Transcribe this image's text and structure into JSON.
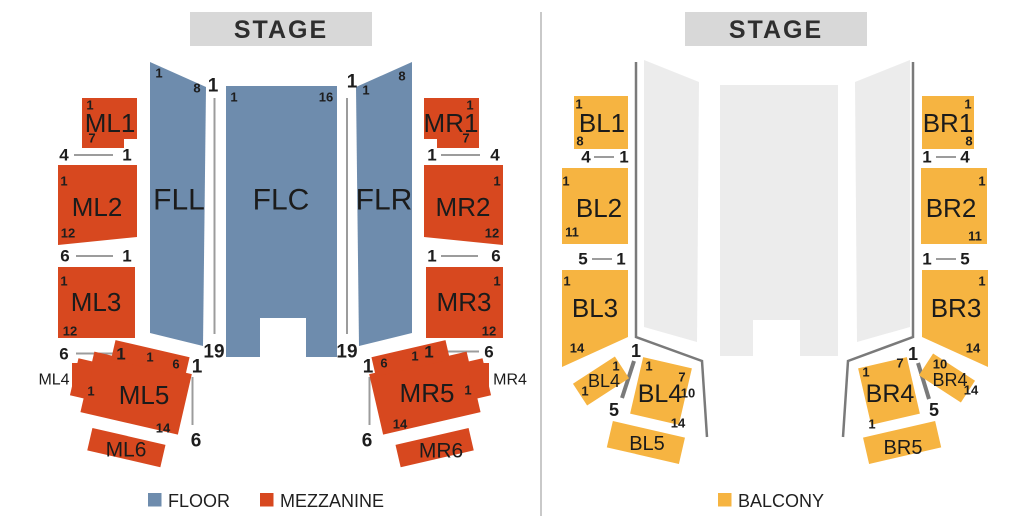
{
  "stage": {
    "label": "STAGE"
  },
  "legend": {
    "floor": "FLOOR",
    "mezzanine": "MEZZANINE",
    "balcony": "BALCONY"
  },
  "colors": {
    "floor": "#6E8CAD",
    "mezzanine": "#D7481F",
    "balcony": "#F6B441",
    "floor_disabled": "#ECECEC"
  },
  "maps": {
    "floor_mezz": {
      "sections": {
        "FLL": "FLL",
        "FLC": "FLC",
        "FLR": "FLR",
        "ML1": "ML1",
        "ML2": "ML2",
        "ML3": "ML3",
        "ML4": "ML4",
        "ML5": "ML5",
        "ML6": "ML6",
        "MR1": "MR1",
        "MR2": "MR2",
        "MR3": "MR3",
        "MR4": "MR4",
        "MR5": "MR5",
        "MR6": "MR6"
      },
      "row_labels": [
        {
          "x": 64,
          "y": 155,
          "t": "4",
          "s": 17
        },
        {
          "x": 127,
          "y": 155,
          "t": "1",
          "s": 17
        },
        {
          "x": 65,
          "y": 256,
          "t": "6",
          "s": 17
        },
        {
          "x": 127,
          "y": 256,
          "t": "1",
          "s": 17
        },
        {
          "x": 64,
          "y": 354,
          "t": "6",
          "s": 17
        },
        {
          "x": 121,
          "y": 354,
          "t": "1",
          "s": 17
        },
        {
          "x": 432,
          "y": 155,
          "t": "1",
          "s": 17
        },
        {
          "x": 495,
          "y": 155,
          "t": "4",
          "s": 17
        },
        {
          "x": 432,
          "y": 256,
          "t": "1",
          "s": 17
        },
        {
          "x": 496,
          "y": 256,
          "t": "6",
          "s": 17
        },
        {
          "x": 429,
          "y": 352,
          "t": "1",
          "s": 17
        },
        {
          "x": 489,
          "y": 352,
          "t": "6",
          "s": 17
        },
        {
          "x": 213,
          "y": 86,
          "t": "1",
          "s": 19
        },
        {
          "x": 352,
          "y": 82,
          "t": "1",
          "s": 19
        },
        {
          "x": 214,
          "y": 352,
          "t": "19",
          "s": 19
        },
        {
          "x": 347,
          "y": 352,
          "t": "19",
          "s": 19
        },
        {
          "x": 197,
          "y": 367,
          "t": "1",
          "s": 19
        },
        {
          "x": 196,
          "y": 441,
          "t": "6",
          "s": 19
        },
        {
          "x": 368,
          "y": 367,
          "t": "1",
          "s": 19
        },
        {
          "x": 367,
          "y": 441,
          "t": "6",
          "s": 19
        },
        {
          "x": 159,
          "y": 73,
          "t": "1",
          "s": 13
        },
        {
          "x": 197,
          "y": 88,
          "t": "8",
          "s": 13
        },
        {
          "x": 234,
          "y": 97,
          "t": "1",
          "s": 13
        },
        {
          "x": 326,
          "y": 97,
          "t": "16",
          "s": 13
        },
        {
          "x": 366,
          "y": 90,
          "t": "1",
          "s": 13
        },
        {
          "x": 402,
          "y": 76,
          "t": "8",
          "s": 13
        },
        {
          "x": 90,
          "y": 105,
          "t": "1",
          "s": 13
        },
        {
          "x": 92,
          "y": 138,
          "t": "7",
          "s": 13
        },
        {
          "x": 470,
          "y": 105,
          "t": "1",
          "s": 13
        },
        {
          "x": 466,
          "y": 138,
          "t": "7",
          "s": 13
        },
        {
          "x": 64,
          "y": 181,
          "t": "1",
          "s": 13
        },
        {
          "x": 68,
          "y": 233,
          "t": "12",
          "s": 13
        },
        {
          "x": 497,
          "y": 181,
          "t": "1",
          "s": 13
        },
        {
          "x": 492,
          "y": 233,
          "t": "12",
          "s": 13
        },
        {
          "x": 64,
          "y": 281,
          "t": "1",
          "s": 13
        },
        {
          "x": 70,
          "y": 331,
          "t": "12",
          "s": 13
        },
        {
          "x": 497,
          "y": 281,
          "t": "1",
          "s": 13
        },
        {
          "x": 489,
          "y": 331,
          "t": "12",
          "s": 13
        },
        {
          "x": 150,
          "y": 357,
          "t": "1",
          "s": 13
        },
        {
          "x": 176,
          "y": 364,
          "t": "6",
          "s": 13
        },
        {
          "x": 91,
          "y": 391,
          "t": "1",
          "s": 13
        },
        {
          "x": 163,
          "y": 428,
          "t": "14",
          "s": 13
        },
        {
          "x": 384,
          "y": 363,
          "t": "6",
          "s": 13
        },
        {
          "x": 415,
          "y": 356,
          "t": "1",
          "s": 13
        },
        {
          "x": 468,
          "y": 390,
          "t": "1",
          "s": 13
        },
        {
          "x": 400,
          "y": 424,
          "t": "14",
          "s": 13
        }
      ]
    },
    "balcony": {
      "sections": {
        "BL1": "BL1",
        "BL2": "BL2",
        "BL3": "BL3",
        "BL4": "BL4",
        "BL4_side": "BL4",
        "BL5": "BL5",
        "BR1": "BR1",
        "BR2": "BR2",
        "BR3": "BR3",
        "BR4": "BR4",
        "BR4_side": "BR4",
        "BR5": "BR5"
      },
      "row_labels": [
        {
          "x": 586,
          "y": 157,
          "t": "4",
          "s": 17
        },
        {
          "x": 624,
          "y": 157,
          "t": "1",
          "s": 17
        },
        {
          "x": 583,
          "y": 259,
          "t": "5",
          "s": 17
        },
        {
          "x": 621,
          "y": 259,
          "t": "1",
          "s": 17
        },
        {
          "x": 927,
          "y": 157,
          "t": "1",
          "s": 17
        },
        {
          "x": 965,
          "y": 157,
          "t": "4",
          "s": 17
        },
        {
          "x": 927,
          "y": 259,
          "t": "1",
          "s": 17
        },
        {
          "x": 965,
          "y": 259,
          "t": "5",
          "s": 17
        },
        {
          "x": 636,
          "y": 351,
          "t": "1",
          "s": 18
        },
        {
          "x": 614,
          "y": 410,
          "t": "5",
          "s": 18
        },
        {
          "x": 913,
          "y": 354,
          "t": "1",
          "s": 18
        },
        {
          "x": 934,
          "y": 410,
          "t": "5",
          "s": 18
        },
        {
          "x": 579,
          "y": 104,
          "t": "1",
          "s": 13
        },
        {
          "x": 580,
          "y": 141,
          "t": "8",
          "s": 13
        },
        {
          "x": 566,
          "y": 181,
          "t": "1",
          "s": 13
        },
        {
          "x": 572,
          "y": 232,
          "t": "11",
          "s": 13
        },
        {
          "x": 567,
          "y": 281,
          "t": "1",
          "s": 13
        },
        {
          "x": 577,
          "y": 348,
          "t": "14",
          "s": 13
        },
        {
          "x": 968,
          "y": 104,
          "t": "1",
          "s": 13
        },
        {
          "x": 969,
          "y": 141,
          "t": "8",
          "s": 13
        },
        {
          "x": 982,
          "y": 181,
          "t": "1",
          "s": 13
        },
        {
          "x": 975,
          "y": 236,
          "t": "11",
          "s": 13
        },
        {
          "x": 982,
          "y": 281,
          "t": "1",
          "s": 13
        },
        {
          "x": 973,
          "y": 348,
          "t": "14",
          "s": 13
        },
        {
          "x": 649,
          "y": 366,
          "t": "1",
          "s": 13
        },
        {
          "x": 682,
          "y": 377,
          "t": "7",
          "s": 13
        },
        {
          "x": 688,
          "y": 393,
          "t": "10",
          "s": 13
        },
        {
          "x": 678,
          "y": 423,
          "t": "14",
          "s": 13
        },
        {
          "x": 616,
          "y": 366,
          "t": "1",
          "s": 13
        },
        {
          "x": 585,
          "y": 391,
          "t": "1",
          "s": 13
        },
        {
          "x": 866,
          "y": 372,
          "t": "1",
          "s": 13
        },
        {
          "x": 900,
          "y": 363,
          "t": "7",
          "s": 13
        },
        {
          "x": 872,
          "y": 424,
          "t": "1",
          "s": 13
        },
        {
          "x": 940,
          "y": 364,
          "t": "10",
          "s": 13
        },
        {
          "x": 971,
          "y": 390,
          "t": "14",
          "s": 13
        }
      ]
    }
  }
}
